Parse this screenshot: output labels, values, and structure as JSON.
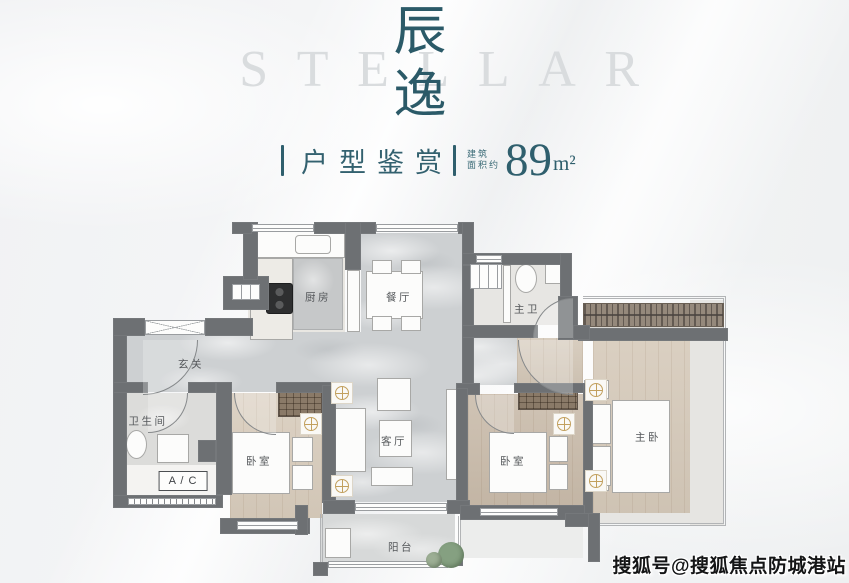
{
  "page": {
    "accent_teal": "#2f5f6d",
    "wall_color": "#6d7073",
    "wood_color": "#d5c9b9",
    "marble_color": "#cdd0d2",
    "gold_color": "#c2a05e"
  },
  "header": {
    "watermark": "STELLAR",
    "title": "辰逸",
    "title_char1": "辰",
    "title_char2": "逸",
    "subtitle": "户型鉴赏",
    "area_prefix1": "建筑",
    "area_prefix2": "面积约",
    "area_value": "89",
    "area_unit": "m²"
  },
  "watermark": {
    "text": "搜狐号@搜狐焦点防城港站"
  },
  "floorplan": {
    "labels": [
      {
        "id": "kitchen",
        "text": "厨房",
        "x": 318,
        "y": 297
      },
      {
        "id": "dining",
        "text": "餐厅",
        "x": 399,
        "y": 297
      },
      {
        "id": "master-bath",
        "text": "主卫",
        "x": 527,
        "y": 309
      },
      {
        "id": "foyer",
        "text": "玄关",
        "x": 191,
        "y": 364
      },
      {
        "id": "bathroom",
        "text": "卫生间",
        "x": 148,
        "y": 421
      },
      {
        "id": "ac",
        "text": "A / C",
        "x": 183,
        "y": 481,
        "boxed": true
      },
      {
        "id": "bedroom-1",
        "text": "卧室",
        "x": 259,
        "y": 461
      },
      {
        "id": "living",
        "text": "客厅",
        "x": 394,
        "y": 441
      },
      {
        "id": "bedroom-2",
        "text": "卧室",
        "x": 513,
        "y": 461
      },
      {
        "id": "master-bedroom",
        "text": "主卧",
        "x": 648,
        "y": 437
      },
      {
        "id": "balcony",
        "text": "阳台",
        "x": 401,
        "y": 547
      }
    ],
    "floors": [
      {
        "x": 248,
        "y": 233,
        "w": 97,
        "h": 107,
        "cls": "marble-light",
        "name": "kitchen-floor"
      },
      {
        "x": 361,
        "y": 233,
        "w": 101,
        "h": 99,
        "cls": "marble",
        "name": "dining-floor"
      },
      {
        "x": 127,
        "y": 332,
        "w": 336,
        "h": 60,
        "cls": "marble",
        "name": "foyer-floor"
      },
      {
        "x": 463,
        "y": 338,
        "w": 54,
        "h": 47,
        "cls": "marble",
        "name": "corridor-floor"
      },
      {
        "x": 517,
        "y": 338,
        "w": 66,
        "h": 47,
        "cls": "wood",
        "fill": "#d3c7b7",
        "name": "vestibule-floor"
      },
      {
        "x": 336,
        "y": 392,
        "w": 120,
        "h": 110,
        "cls": "marble",
        "name": "living-floor"
      },
      {
        "x": 320,
        "y": 514,
        "w": 135,
        "h": 50,
        "cls": "marble-light2",
        "name": "balcony-floor"
      },
      {
        "x": 474,
        "y": 265,
        "w": 86,
        "h": 60,
        "cls": "tile",
        "name": "masterbath-floor"
      },
      {
        "x": 127,
        "y": 393,
        "w": 89,
        "h": 72,
        "cls": "tile2",
        "name": "bathroom-floor"
      },
      {
        "x": 123,
        "y": 465,
        "w": 100,
        "h": 30,
        "fill": "#f4f3f1",
        "name": "ac-floor"
      },
      {
        "x": 230,
        "y": 393,
        "w": 92,
        "h": 125,
        "cls": "wood",
        "fill": "#d8ccbc",
        "name": "bedroom1-floor"
      },
      {
        "x": 468,
        "y": 394,
        "w": 115,
        "h": 111,
        "cls": "wood",
        "fill": "#c9bbaa",
        "name": "bedroom2-floor"
      },
      {
        "x": 593,
        "y": 340,
        "w": 97,
        "h": 175,
        "cls": "wood",
        "fill": "#d5c9b9",
        "name": "master-floor"
      },
      {
        "x": 690,
        "y": 300,
        "w": 34,
        "h": 226,
        "fill": "#e6e5e2",
        "name": "terrace-right-floor"
      },
      {
        "x": 593,
        "y": 513,
        "w": 131,
        "h": 11,
        "fill": "#e6e5e2",
        "name": "terrace-bottom-floor"
      },
      {
        "x": 583,
        "y": 327,
        "w": 141,
        "h": 13,
        "fill": "#dad9d6",
        "name": "terrace-top-strip"
      },
      {
        "x": 460,
        "y": 520,
        "w": 123,
        "h": 38,
        "fill": "#ecedec",
        "name": "ground-bottom-right"
      }
    ],
    "walls": [
      [
        113,
        318,
        14,
        190
      ],
      [
        113,
        318,
        32,
        18
      ],
      [
        205,
        318,
        48,
        18
      ],
      [
        223,
        276,
        46,
        34
      ],
      [
        243,
        222,
        15,
        58
      ],
      [
        232,
        222,
        20,
        12
      ],
      [
        314,
        222,
        62,
        12
      ],
      [
        458,
        222,
        16,
        12
      ],
      [
        462,
        222,
        12,
        45
      ],
      [
        462,
        253,
        110,
        12
      ],
      [
        560,
        253,
        12,
        55
      ],
      [
        558,
        296,
        20,
        44
      ],
      [
        578,
        328,
        150,
        13
      ],
      [
        462,
        265,
        12,
        120
      ],
      [
        462,
        325,
        76,
        13
      ],
      [
        573,
        325,
        17,
        15
      ],
      [
        345,
        222,
        16,
        48
      ],
      [
        456,
        383,
        24,
        12
      ],
      [
        514,
        383,
        74,
        10
      ],
      [
        583,
        383,
        10,
        132
      ],
      [
        456,
        388,
        12,
        114
      ],
      [
        113,
        382,
        35,
        11
      ],
      [
        188,
        382,
        28,
        11
      ],
      [
        216,
        382,
        16,
        113
      ],
      [
        276,
        382,
        60,
        11
      ],
      [
        322,
        385,
        14,
        118
      ],
      [
        198,
        440,
        18,
        22
      ],
      [
        113,
        495,
        110,
        13
      ],
      [
        220,
        518,
        90,
        16
      ],
      [
        295,
        505,
        13,
        30
      ],
      [
        323,
        500,
        32,
        14
      ],
      [
        447,
        500,
        23,
        14
      ],
      [
        460,
        505,
        125,
        15
      ],
      [
        565,
        513,
        35,
        14
      ],
      [
        588,
        513,
        12,
        49
      ],
      [
        313,
        562,
        15,
        14
      ],
      [
        448,
        552,
        15,
        14
      ]
    ],
    "windows": [
      {
        "x": 252,
        "y": 224,
        "w": 62,
        "h": 8,
        "t": "h"
      },
      {
        "x": 376,
        "y": 224,
        "w": 82,
        "h": 8,
        "t": "h"
      },
      {
        "x": 476,
        "y": 255,
        "w": 26,
        "h": 8,
        "t": "h"
      },
      {
        "x": 145,
        "y": 320,
        "w": 60,
        "h": 15,
        "t": "x"
      },
      {
        "x": 232,
        "y": 284,
        "w": 28,
        "h": 16,
        "t": "v"
      },
      {
        "x": 470,
        "y": 264,
        "w": 32,
        "h": 25,
        "t": "v"
      },
      {
        "x": 237,
        "y": 521,
        "w": 61,
        "h": 9,
        "t": "h"
      },
      {
        "x": 480,
        "y": 508,
        "w": 78,
        "h": 8,
        "t": "h"
      },
      {
        "x": 355,
        "y": 503,
        "w": 92,
        "h": 8,
        "t": "h"
      },
      {
        "x": 328,
        "y": 561,
        "w": 120,
        "h": 7,
        "t": "h"
      },
      {
        "x": 128,
        "y": 498,
        "w": 88,
        "h": 7,
        "t": "v2"
      }
    ],
    "furniture": [
      {
        "x": 250,
        "y": 231,
        "w": 95,
        "h": 27,
        "k": "wht",
        "name": "kitchen-counter"
      },
      {
        "x": 295,
        "y": 235,
        "w": 36,
        "h": 19,
        "k": "wht",
        "r": 4,
        "name": "kitchen-sink"
      },
      {
        "x": 250,
        "y": 258,
        "w": 43,
        "h": 82,
        "k": "wht",
        "fill": "#edebe6",
        "name": "kitchen-counter-left"
      },
      {
        "x": 293,
        "y": 258,
        "w": 50,
        "h": 72,
        "k": "slab",
        "name": "kitchen-island"
      },
      {
        "x": 266,
        "y": 283,
        "w": 27,
        "h": 31,
        "k": "stove",
        "name": "stove"
      },
      {
        "x": 347,
        "y": 270,
        "w": 13,
        "h": 62,
        "k": "wht",
        "name": "fridge"
      },
      {
        "x": 366,
        "y": 271,
        "w": 57,
        "h": 48,
        "k": "wht",
        "name": "dining-table"
      },
      {
        "x": 372,
        "y": 260,
        "w": 20,
        "h": 14,
        "k": "wht",
        "name": "chair"
      },
      {
        "x": 401,
        "y": 260,
        "w": 20,
        "h": 14,
        "k": "wht",
        "name": "chair"
      },
      {
        "x": 372,
        "y": 316,
        "w": 20,
        "h": 15,
        "k": "wht",
        "name": "chair"
      },
      {
        "x": 401,
        "y": 316,
        "w": 20,
        "h": 15,
        "k": "wht",
        "name": "chair"
      },
      {
        "x": 503,
        "y": 265,
        "w": 8,
        "h": 58,
        "k": "wht",
        "name": "bath-partition"
      },
      {
        "x": 515,
        "y": 264,
        "w": 22,
        "h": 29,
        "k": "oval",
        "name": "toilet"
      },
      {
        "x": 545,
        "y": 263,
        "w": 24,
        "h": 21,
        "k": "wht",
        "name": "washbasin"
      },
      {
        "x": 126,
        "y": 430,
        "w": 21,
        "h": 29,
        "k": "oval",
        "name": "toilet"
      },
      {
        "x": 157,
        "y": 434,
        "w": 32,
        "h": 29,
        "k": "wht",
        "name": "shower"
      },
      {
        "x": 232,
        "y": 432,
        "w": 58,
        "h": 62,
        "k": "wht",
        "name": "bed"
      },
      {
        "x": 292,
        "y": 437,
        "w": 21,
        "h": 25,
        "k": "wht",
        "name": "pillow"
      },
      {
        "x": 292,
        "y": 465,
        "w": 21,
        "h": 25,
        "k": "wht",
        "name": "pillow"
      },
      {
        "x": 377,
        "y": 378,
        "w": 34,
        "h": 33,
        "k": "wht",
        "name": "sideboard"
      },
      {
        "x": 327,
        "y": 408,
        "w": 39,
        "h": 64,
        "k": "wht",
        "name": "sofa"
      },
      {
        "x": 379,
        "y": 420,
        "w": 33,
        "h": 37,
        "k": "wht",
        "name": "coffee-table"
      },
      {
        "x": 371,
        "y": 467,
        "w": 42,
        "h": 19,
        "k": "wht",
        "name": "rug"
      },
      {
        "x": 446,
        "y": 389,
        "w": 11,
        "h": 91,
        "k": "wht",
        "name": "tv-cabinet"
      },
      {
        "x": 489,
        "y": 432,
        "w": 58,
        "h": 61,
        "k": "wht",
        "name": "bed"
      },
      {
        "x": 549,
        "y": 436,
        "w": 19,
        "h": 26,
        "k": "wht",
        "name": "pillow"
      },
      {
        "x": 549,
        "y": 464,
        "w": 19,
        "h": 26,
        "k": "wht",
        "name": "pillow"
      },
      {
        "x": 584,
        "y": 380,
        "w": 25,
        "h": 19,
        "k": "wht",
        "name": "nightstand"
      },
      {
        "x": 584,
        "y": 472,
        "w": 25,
        "h": 19,
        "k": "wht",
        "name": "nightstand"
      },
      {
        "x": 612,
        "y": 400,
        "w": 58,
        "h": 93,
        "k": "wht",
        "name": "bed-master"
      },
      {
        "x": 590,
        "y": 404,
        "w": 21,
        "h": 40,
        "k": "wht",
        "name": "pillow"
      },
      {
        "x": 590,
        "y": 446,
        "w": 21,
        "h": 40,
        "k": "wht",
        "name": "pillow"
      },
      {
        "x": 325,
        "y": 528,
        "w": 26,
        "h": 30,
        "k": "wht",
        "name": "washer"
      }
    ],
    "hatches": [
      {
        "x": 278,
        "y": 390,
        "w": 44,
        "h": 27,
        "t": "w"
      },
      {
        "x": 518,
        "y": 386,
        "w": 60,
        "h": 24,
        "t": "w"
      },
      {
        "x": 583,
        "y": 303,
        "w": 141,
        "h": 24,
        "t": "d"
      }
    ],
    "arcs": [
      {
        "x": 143,
        "y": 340,
        "r": 55,
        "c": "br"
      },
      {
        "x": 148,
        "y": 393,
        "r": 40,
        "c": "br"
      },
      {
        "x": 234,
        "y": 393,
        "r": 42,
        "c": "bl"
      },
      {
        "x": 475,
        "y": 395,
        "r": 39,
        "c": "bl"
      },
      {
        "x": 518,
        "y": 340,
        "r": 55,
        "c": "bl"
      },
      {
        "x": 533,
        "y": 298,
        "r": 40,
        "c": "tl"
      }
    ],
    "lamps": [
      [
        342,
        393
      ],
      [
        342,
        486
      ],
      [
        311,
        424
      ],
      [
        564,
        424
      ],
      [
        596,
        390
      ],
      [
        596,
        481
      ]
    ],
    "plants": [
      {
        "cx": 451,
        "cy": 555,
        "r": 13,
        "fill": "#85a081"
      },
      {
        "cx": 434,
        "cy": 560,
        "r": 8,
        "fill": "#9cae94"
      }
    ],
    "frames": [
      {
        "x": 583,
        "y": 296,
        "w": 143,
        "h": 230,
        "sides": "trb"
      },
      {
        "x": 320,
        "y": 514,
        "w": 3,
        "h": 50,
        "sides": "l"
      },
      {
        "x": 458,
        "y": 516,
        "w": 3,
        "h": 40,
        "sides": "l"
      }
    ]
  }
}
